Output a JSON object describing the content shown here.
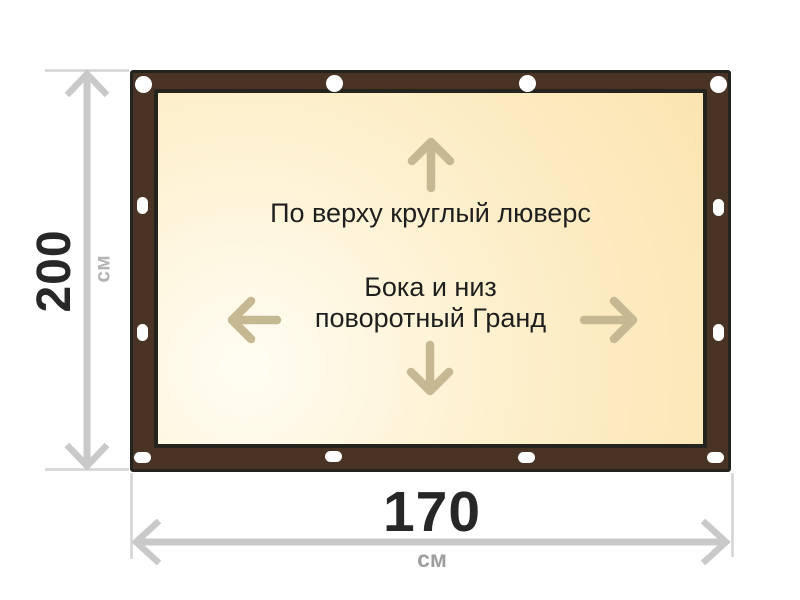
{
  "banner": {
    "top_note": "По верху круглый люверс",
    "middle_note_line1": "Бока и низ",
    "middle_note_line2": "поворотный Гранд",
    "grommets": {
      "top_round_count": 4,
      "bottom_oval_count": 4,
      "left_oval_count": 2,
      "right_oval_count": 2
    }
  },
  "dimensions": {
    "height": {
      "value": "200",
      "unit": "см"
    },
    "width": {
      "value": "170",
      "unit": "см"
    }
  },
  "icons": {
    "up": "arrow-up-icon",
    "down": "arrow-down-icon",
    "left": "arrow-left-icon",
    "right": "arrow-right-icon",
    "grommet_round": "grommet-round-icon",
    "grommet_oval": "grommet-oval-icon"
  },
  "theme": {
    "frame_brown": "#483325",
    "frame_outline": "#25231e",
    "canvas_gradient_light": "#fffdf3",
    "canvas_gradient_mid": "#fdf0cd",
    "canvas_gradient_warm": "#fbe4b0",
    "grommet_white": "#ffffff",
    "inner_arrow_tan": "#c5b892",
    "dimension_gray": "#c9c9c9",
    "extension_gray": "#d4d4d4",
    "value_text_dark": "#272727",
    "note_text_dark": "#1f1f1f",
    "unit_gray_bottom": "#9e9e9e",
    "unit_gray_left": "#b4b4b4"
  }
}
